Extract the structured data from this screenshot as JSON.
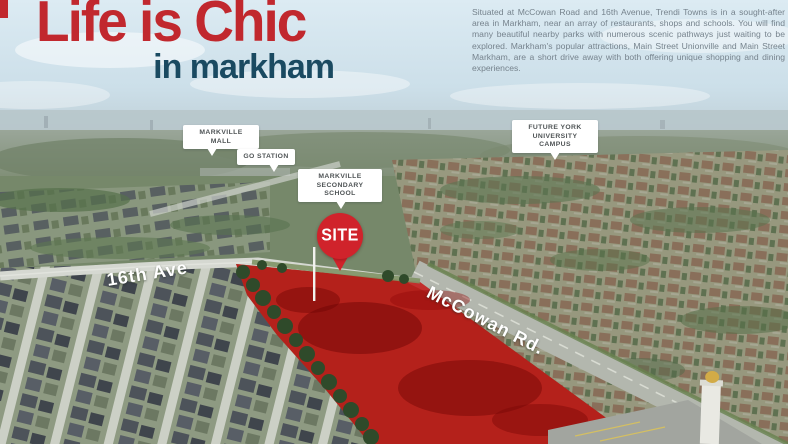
{
  "header": {
    "title_line1": "Life is Chic",
    "title_line2": "in markham",
    "title_color": "#c1282e",
    "subtitle_color": "#1a4a61",
    "intro_text": "Situated at McCowan Road and 16th Avenue, Trendi Towns is in a sought-after area in Markham, near an array of restaurants, shops and schools. You will find many beautiful nearby parks with numerous scenic pathways just waiting to be explored. Markham's popular attractions, Main Street Unionville and Main Street Markham, are a short drive away with both offering unique shopping and dining experiences."
  },
  "map": {
    "callouts": [
      {
        "id": "markville-mall",
        "label": "MARKVILLE MALL"
      },
      {
        "id": "go-station",
        "label": "GO STATION"
      },
      {
        "id": "markville-secondary-school",
        "label": "MARKVILLE SECONDARY SCHOOL"
      },
      {
        "id": "future-york-university-campus",
        "label": "FUTURE YORK UNIVERSITY CAMPUS"
      }
    ],
    "site_marker": {
      "label": "SITE",
      "color": "#d0232b"
    },
    "roads": [
      {
        "label": "16th Ave"
      },
      {
        "label": "McCowan Rd."
      }
    ],
    "site_area_color": "#c50d0d"
  }
}
